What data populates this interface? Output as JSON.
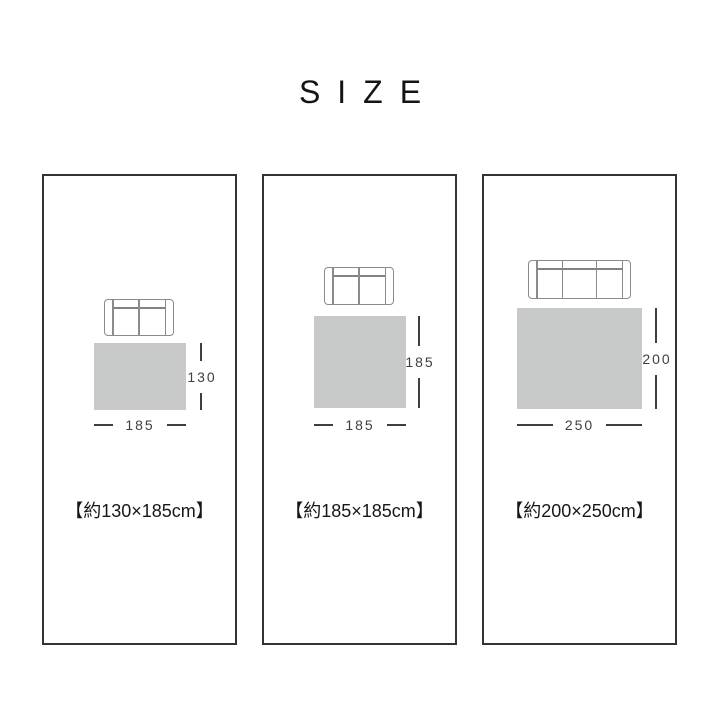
{
  "page": {
    "title": "SIZE",
    "background": "#ffffff"
  },
  "colors": {
    "panel_border": "#333333",
    "rug_fill": "#c8c9c9",
    "dimension_line": "#3f3f3f",
    "sofa_outline": "#8b8b8b",
    "text": "#171717"
  },
  "panels": [
    {
      "caption": "【約130×185cm】",
      "sofa_seats": 2,
      "rug": {
        "height_label": "130",
        "width_label": "185"
      }
    },
    {
      "caption": "【約185×185cm】",
      "sofa_seats": 2,
      "rug": {
        "height_label": "185",
        "width_label": "185"
      }
    },
    {
      "caption": "【約200×250cm】",
      "sofa_seats": 3,
      "rug": {
        "height_label": "200",
        "width_label": "250"
      }
    }
  ]
}
